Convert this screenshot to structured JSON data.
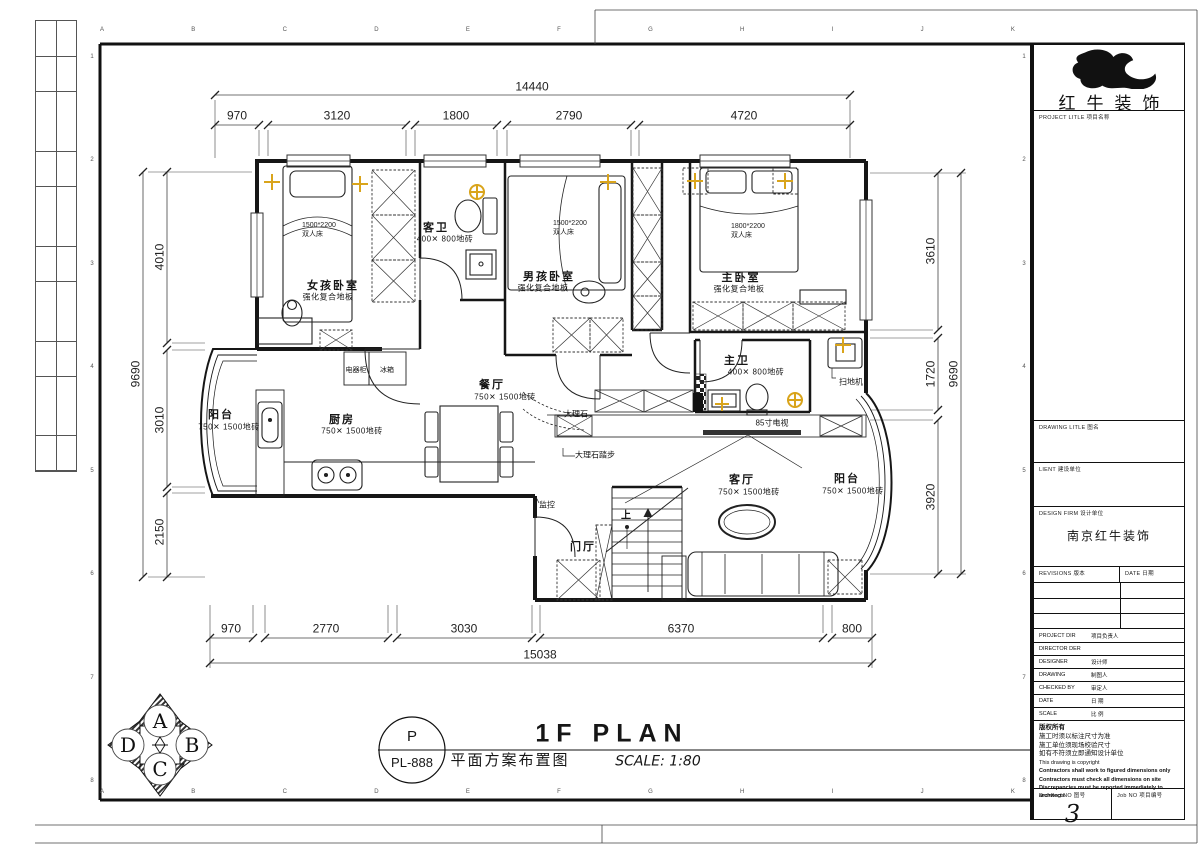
{
  "sheet": {
    "grid_letters": [
      "A",
      "B",
      "C",
      "D",
      "E",
      "F",
      "G",
      "H",
      "I",
      "J",
      "K"
    ],
    "grid_numbers": [
      "1",
      "2",
      "3",
      "4",
      "5",
      "6",
      "7",
      "8"
    ]
  },
  "title_block": {
    "company_name": "红牛装饰",
    "project_title_label": "PROJECT LITLE  项目名称",
    "drawing_title_label": "DRAWING LITLE  图名",
    "client_label": "LIENT  建设单位",
    "design_firm_label": "DESIGN FIRM  设计单位",
    "design_firm_value": "南京红牛装饰",
    "revisions_label": "REVISIONS  版本",
    "revision_date_label": "DATE  日期",
    "rows": [
      {
        "en": "PROJECT DIR",
        "cn": "项目负责人"
      },
      {
        "en": "DIRECTOR DER",
        "cn": ""
      },
      {
        "en": "DESIGNER",
        "cn": "设计师"
      },
      {
        "en": "DRAWING",
        "cn": "制图人"
      },
      {
        "en": "CHECKED BY",
        "cn": "审定人"
      },
      {
        "en": "DATE",
        "cn": "日 期"
      },
      {
        "en": "SCALE",
        "cn": "比 例"
      }
    ],
    "copyright_lines": [
      "版权所有",
      "施工时须以标注尺寸为准",
      "施工单位须现场校验尺寸",
      "如有不符须立即通知设计单位",
      "This drawing is copyright",
      "Contractors shall work to figured dimensions only",
      "Contractors must check all dimensions on site",
      "Discrepancies must be reported immediately to architects"
    ],
    "drawing_no_label": "Drawing NO 图号",
    "drawing_no_value": "3",
    "job_no_label": "Job NO 项目编号"
  },
  "footer": {
    "ref_top": "P",
    "ref_bottom": "PL-888",
    "plan_title": "1F PLAN",
    "plan_subtitle": "平面方案布置图",
    "scale_text": "SCALE: 1:80"
  },
  "compass": {
    "top": "A",
    "right": "B",
    "bottom": "C",
    "left": "D"
  },
  "dims": {
    "top_total": "14440",
    "top": [
      "970",
      "3120",
      "1800",
      "2790",
      "4720"
    ],
    "left_total": "9690",
    "left": [
      "4010",
      "3010",
      "2150"
    ],
    "right_total": "9690",
    "right": [
      "3610",
      "1720",
      "3920"
    ],
    "bottom_total": "15038",
    "bottom": [
      "970",
      "2770",
      "3030",
      "6370",
      "800"
    ]
  },
  "rooms": {
    "girl_bedroom": {
      "name": "女孩卧室",
      "floor": "强化复合地板"
    },
    "guest_bath": {
      "name": "客卫",
      "floor": "400✕ 800地砖"
    },
    "boy_bedroom": {
      "name": "男孩卧室",
      "floor": "强化复合地板"
    },
    "master_bedroom": {
      "name": "主卧室",
      "floor": "强化复合地板"
    },
    "master_bath": {
      "name": "主卫",
      "floor": "400✕ 800地砖"
    },
    "dining": {
      "name": "餐厅",
      "floor": "750✕ 1500地砖"
    },
    "kitchen": {
      "name": "厨房",
      "floor": "750✕ 1500地砖"
    },
    "balcony_left": {
      "name": "阳台",
      "floor": "750✕ 1500地砖"
    },
    "living": {
      "name": "客厅",
      "floor": "750✕ 1500地砖"
    },
    "balcony_right": {
      "name": "阳台",
      "floor": "750✕ 1500地砖"
    },
    "foyer": {
      "name": "门厅"
    }
  },
  "furniture": {
    "bed_girl": {
      "size": "1500*2200",
      "type": "双人床"
    },
    "bed_boy": {
      "size": "1500*2200",
      "type": "双人床"
    },
    "bed_master": {
      "size": "1800*2200",
      "type": "双人床"
    }
  },
  "annotations": {
    "appliance_cabinet": "电器柜",
    "fridge": "冰箱",
    "marble": "大理石",
    "marble_step": "大理石踏步",
    "monitor": "监控",
    "tv": "85寸电视",
    "robot_vacuum": "扫地机",
    "stairs_up": "上"
  }
}
